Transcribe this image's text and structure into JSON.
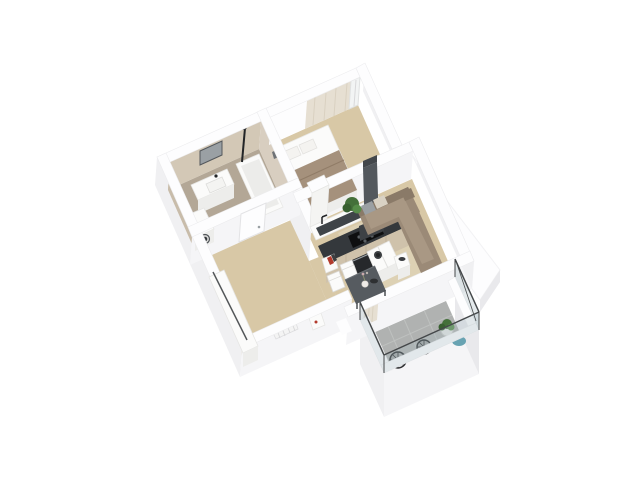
{
  "title": "3D apartment floor plan render",
  "scene": {
    "type": "isometric-3d-floorplan",
    "rooms": [
      {
        "name": "bathroom",
        "furniture": [
          "mirror",
          "vanity-sink",
          "bathtub",
          "shower-column",
          "washing-machine"
        ]
      },
      {
        "name": "hallway",
        "furniture": [
          "sideboard",
          "wall-rail",
          "radiator",
          "shoe-rack",
          "bathroom-door"
        ]
      },
      {
        "name": "bedroom",
        "furniture": [
          "double-bed",
          "pillows",
          "blanket",
          "window",
          "curtains",
          "bedside-table"
        ]
      },
      {
        "name": "kitchen",
        "furniture": [
          "tall-cabinet",
          "sink-island",
          "faucet",
          "counter",
          "cooktop",
          "oven",
          "range-hood",
          "shelf-with-books"
        ]
      },
      {
        "name": "living-room",
        "furniture": [
          "corner-sofa",
          "pillows",
          "potted-plant",
          "coffee-table",
          "speaker",
          "air-purifier",
          "dining-table",
          "chairs",
          "vase",
          "door-curtain"
        ]
      },
      {
        "name": "balcony",
        "furniture": [
          "wire-chair",
          "wire-chair",
          "plant-stand",
          "potted-plant",
          "blue-cushion",
          "glass-railing"
        ]
      },
      {
        "name": "adjacent-roof-slab",
        "furniture": []
      }
    ]
  },
  "colors": {
    "pageBg": "#ffffff",
    "wallTop": "#fdfdfe",
    "wallFace": "#f0f0f2",
    "wallFaceLight": "#f5f5f7",
    "wallFaceShade": "#e9e9ec",
    "floorMain": "#d8c8a6",
    "floorBath": "#b3a796",
    "floorBalcony": "#b0b2b1",
    "rug": "#ddd1b4",
    "tileBath": "#d3c8b6",
    "tileBathDark": "#c8bcaa",
    "tileBathLight": "#d8cec0",
    "curtain": "#e6dfd2",
    "curtainLine": "#d9d1c1",
    "counterTop": "#34383c",
    "cabinet": "#cfc2ab",
    "cabinetShade": "#bdb098",
    "cooktop": "#0e0f10",
    "oven": "#26282b",
    "hood": "#53585d",
    "hoodDark": "#43474b",
    "hoodMouth": "#3d4145",
    "white": "#fbfbfa",
    "whiteShade": "#ededeb",
    "sofa": "#9b8a77",
    "sofaLight": "#a99884",
    "sofaDark": "#8a7a68",
    "blanket": "#a5917c",
    "blanketFold": "#907c67",
    "grayPillow": "#9ba0a3",
    "creamPillow": "#d9d2c4",
    "plant": "#44703a",
    "plantDark": "#386030",
    "plantLight": "#568c49",
    "metal": "#2c2e30",
    "glass": "rgba(165,185,192,0.30)",
    "glassLine": "#45484a",
    "tableDark": "#565b60",
    "tableEdge": "#6a6f74",
    "mirror": "#9aa0a4",
    "mirrorStroke": "#54585c",
    "dark": "#232527",
    "accentBlue": "#68a3b2",
    "accentRed": "#b23a2c",
    "floorLine": "#c2c4c3",
    "radiatorLine": "#d8d8da",
    "bandStroke": "#ececee"
  }
}
